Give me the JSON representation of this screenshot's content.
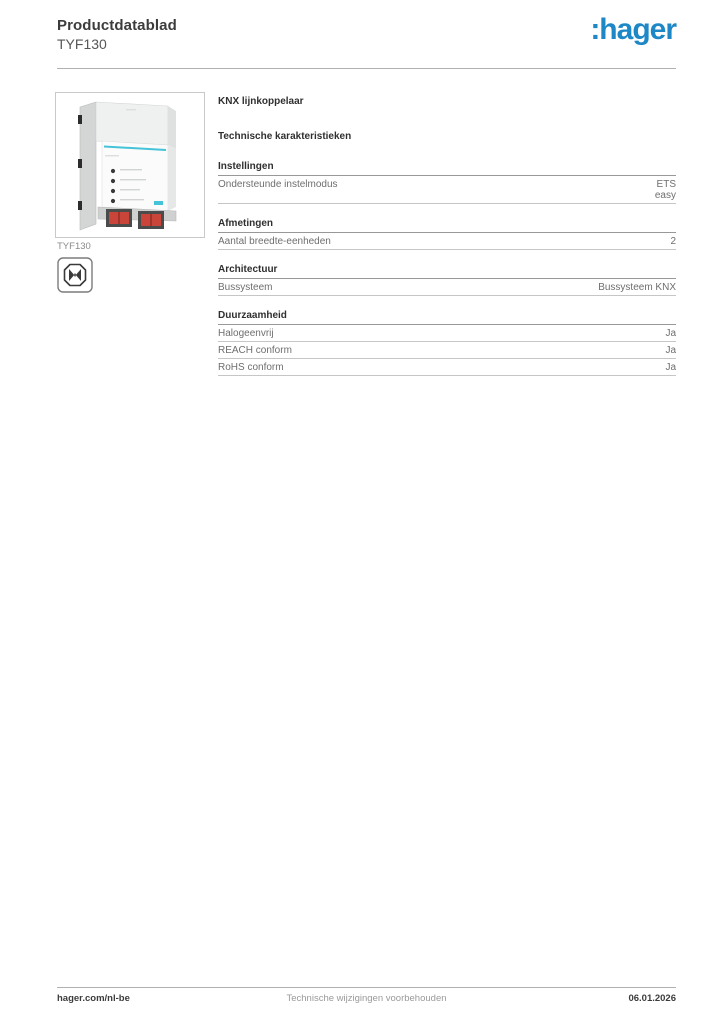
{
  "header": {
    "doc_type": "Productdatablad",
    "product_ref": "TYF130",
    "logo_text": ":hager",
    "logo_color": "#1e87c6"
  },
  "product": {
    "image_caption": "TYF130",
    "image_description": "KNX DIN-rail line coupler module with teal stripe, four indicator LEDs and two red bus terminals",
    "icon": "halogen-free-icon",
    "device_teal": "#45c3d8",
    "terminal_red": "#c9453a"
  },
  "main": {
    "product_title": "KNX lijnkoppelaar",
    "section_title": "Technische karakteristieken",
    "groups": [
      {
        "title": "Instellingen",
        "rows": [
          {
            "label": "Ondersteunde instelmodus",
            "value": "ETS\neasy"
          }
        ]
      },
      {
        "title": "Afmetingen",
        "rows": [
          {
            "label": "Aantal breedte-eenheden",
            "value": "2"
          }
        ]
      },
      {
        "title": "Architectuur",
        "rows": [
          {
            "label": "Bussysteem",
            "value": "Bussysteem KNX"
          }
        ]
      },
      {
        "title": "Duurzaamheid",
        "rows": [
          {
            "label": "Halogeenvrij",
            "value": "Ja"
          },
          {
            "label": "REACH conform",
            "value": "Ja"
          },
          {
            "label": "RoHS conform",
            "value": "Ja"
          }
        ]
      }
    ]
  },
  "footer": {
    "website": "hager.com/nl-be",
    "disclaimer": "Technische wijzigingen voorbehouden",
    "date": "06.01.2026"
  }
}
